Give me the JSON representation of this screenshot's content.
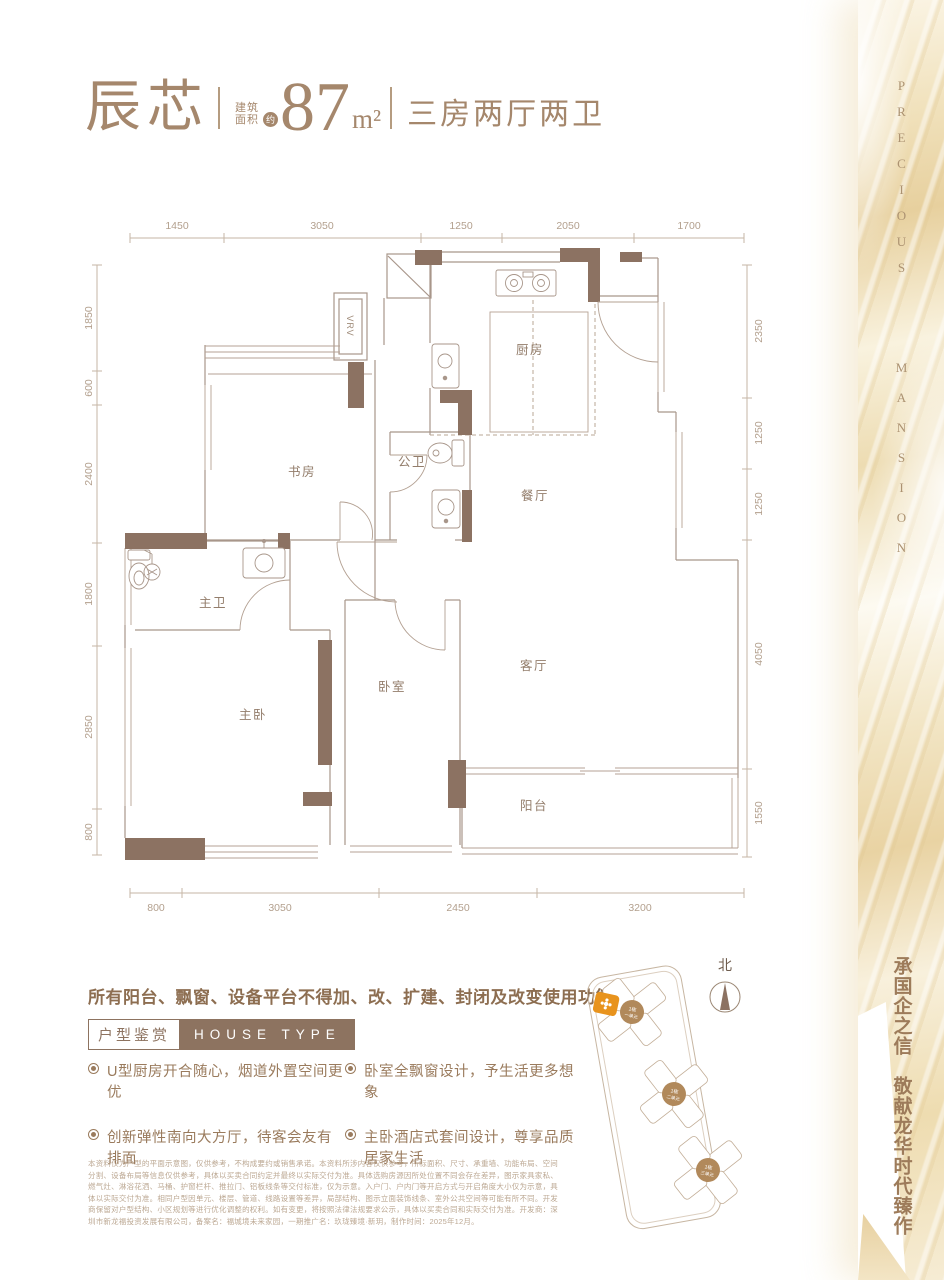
{
  "header": {
    "unit_name": "辰芯",
    "area_label_top": "建筑",
    "area_label_bottom": "面积",
    "area_approx_badge": "约",
    "area_value": "87",
    "area_unit": "m²",
    "layout_desc": "三房两厅两卫"
  },
  "plan": {
    "dims_top": [
      "1450",
      "3050",
      "1250",
      "2050",
      "1700"
    ],
    "dims_left": [
      "1850",
      "600",
      "2400",
      "1800",
      "2850",
      "800"
    ],
    "dims_right": [
      "2350",
      "1250",
      "1250",
      "4050",
      "1550"
    ],
    "dims_bottom": [
      "800",
      "3050",
      "2450",
      "3200"
    ],
    "shaft_label": "VRV",
    "rooms": {
      "kitchen": "厨房",
      "study": "书房",
      "guest_bath": "公卫",
      "dining": "餐厅",
      "master_bath": "主卫",
      "living": "客厅",
      "bedroom": "卧室",
      "master_bedroom": "主卧",
      "balcony": "阳台"
    }
  },
  "notice": "所有阳台、飘窗、设备平台不得加、改、扩建、封闭及改变使用功能",
  "section": {
    "badge_cn": "户型鉴赏",
    "badge_en": "HOUSE TYPE"
  },
  "features": [
    "U型厨房开合随心，烟道外置空间更优",
    "卧室全飘窗设计，予生活更多想象",
    "创新弹性南向大方厅，待客会友有排面",
    "主卧酒店式套间设计，尊享品质居家生活"
  ],
  "disclaimer": "本资料仅为户型的平面示意图，仅供参考，不构成要约或销售承诺。本资料所涉内容仅供参考，所标面积、尺寸、承重墙、功能布局、空间分割、设备布局等信息仅供参考，具体以买卖合同约定并最终以实际交付为准。具体选购房源因所处位置不同会存在差异，图示家具家私、燃气灶、淋浴花洒、马桶、护窗栏杆、推拉门、铝板线条等交付标准，仅为示意。入户门、户内门等开启方式与开启角度大小仅为示意，具体以实际交付为准。相同户型因单元、楼层、管道、线路设置等差异，局部结构、图示立面装饰线条、室外公共空间等可能有所不同。开发商保留对户型结构、小区规划等进行优化调整的权利。如有变更，将按照法律法规要求公示，具体以买卖合同和实际交付为准。开发商：深圳市新龙福投资发展有限公司，备案名：福城境未来家园，一期推广名：玖珑臻境·新玥，制作时间：2025年12月。",
  "sitemap": {
    "north_label": "北",
    "buildings": [
      {
        "line1": "1栋",
        "line2": "一单元"
      },
      {
        "line1": "1栋",
        "line2": "二单元"
      },
      {
        "line1": "1栋",
        "line2": "三单元"
      }
    ]
  },
  "side_band": {
    "en_word_1": "PRECIOUS",
    "en_word_2": "MANSION",
    "cn_slogan": "承国企之信　敬献龙华时代臻作"
  },
  "colors": {
    "brand_brown": "#a5876c",
    "wall_brown": "#8c7262",
    "accent_orange": "#e8931d",
    "gold_band": "#e9d3a2"
  }
}
